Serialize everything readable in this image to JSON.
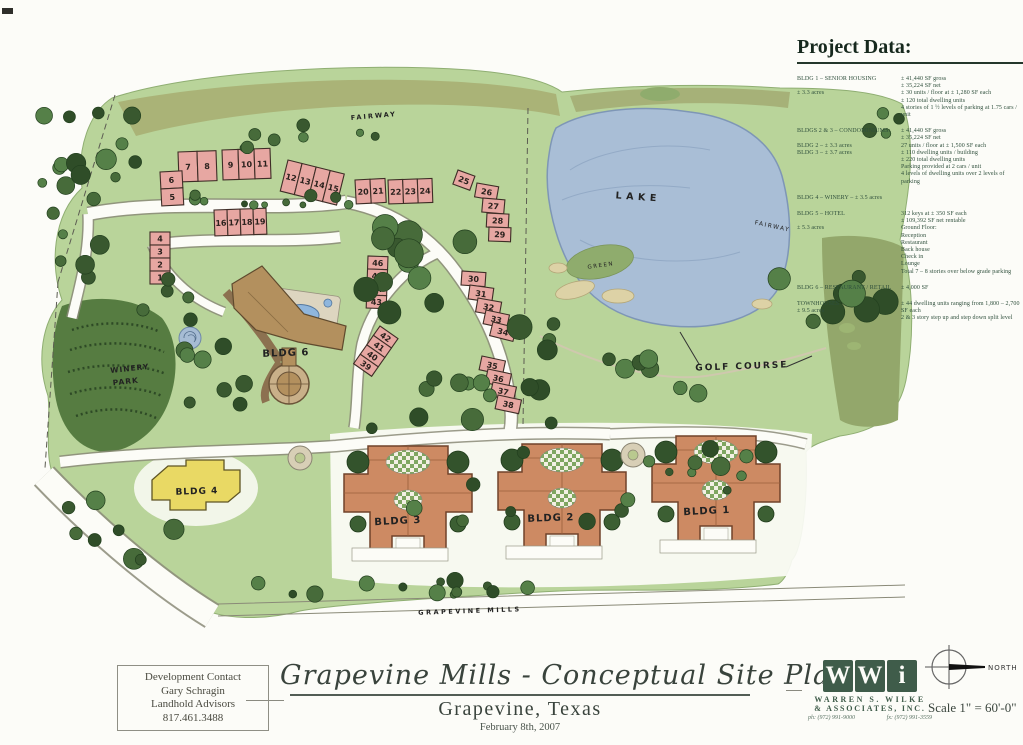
{
  "project_data": {
    "heading": "Project Data:",
    "sections": [
      {
        "left": [
          "BLDG 1 – SENIOR HOUSING",
          "",
          "± 3.3 acres"
        ],
        "right": [
          "± 41,440 SF gross",
          "± 35,224 SF net",
          "± 30 units / floor at ± 1,280 SF each",
          "± 120 total dwelling units",
          "4 stories of 1 ½ levels of parking at 1.75 cars / unit"
        ]
      },
      {
        "left": [
          "BLDGS 2 & 3 – CONDOMINIUMS:",
          "",
          "BLDG 2 – ± 3.3 acres",
          "BLDG 3 – ± 3.7  acres"
        ],
        "right": [
          "± 41,440 SF gross",
          "± 35,224 SF net",
          "27 units / floor at ± 1,500 SF each",
          "± 110 dwelling units / building",
          "± 220 total dwelling units",
          "Parking provided at 2 cars / unit",
          "4 levels of dwelling units over 2 levels of parking"
        ]
      },
      {
        "left": [
          "BLDG 4 – WINERY – ± 3.5 acres"
        ],
        "right": [
          ""
        ]
      },
      {
        "left": [
          "BLDG 5 – HOTEL",
          "",
          "± 5.3 acres"
        ],
        "right": [
          "312 keys at ± 350 SF each",
          "± 109,392 SF net rentable",
          "Ground Floor:",
          "Reception",
          "Restaurant",
          "Back house",
          "Check in",
          "Lounge",
          "Total 7 – 8 stories over below grade parking"
        ]
      },
      {
        "left": [
          "BLDG 6 – RESTAURANT / RETAIL"
        ],
        "right": [
          "± 4,000 SF"
        ]
      },
      {
        "left": [
          "TOWNHOUSES",
          "± 9.5 acres"
        ],
        "right": [
          "± 44 dwelling units ranging from 1,800 – 2,700 SF each",
          "2 & 3 story step up and step down split level"
        ]
      }
    ]
  },
  "map": {
    "labels": {
      "lake": "LAKE",
      "golf_course": "GOLF COURSE",
      "fairway": "FAIRWAY",
      "green": "GREEN",
      "winery_line1": "WINERY",
      "winery_line2": "PARK",
      "street": "GRAPEVINE  MILLS",
      "bldg1": "BLDG 1",
      "bldg2": "BLDG 2",
      "bldg3": "BLDG 3",
      "bldg4": "BLDG 4",
      "bldg6": "BLDG 6"
    },
    "townhouse_clusters": [
      {
        "x": 178,
        "y": 152,
        "w": 38,
        "h": 30,
        "rot": -2,
        "dir": "h",
        "nums": [
          "7",
          "8"
        ]
      },
      {
        "x": 222,
        "y": 150,
        "w": 48,
        "h": 30,
        "rot": -2,
        "dir": "h",
        "nums": [
          "9",
          "10",
          "11"
        ]
      },
      {
        "x": 160,
        "y": 172,
        "w": 22,
        "h": 34,
        "rot": -3,
        "dir": "v",
        "nums": [
          "6",
          "5"
        ]
      },
      {
        "x": 288,
        "y": 160,
        "w": 58,
        "h": 32,
        "rot": 14,
        "dir": "h",
        "nums": [
          "12",
          "13",
          "14",
          "15"
        ]
      },
      {
        "x": 214,
        "y": 210,
        "w": 52,
        "h": 26,
        "rot": -2,
        "dir": "h",
        "nums": [
          "16",
          "17",
          "18",
          "19"
        ]
      },
      {
        "x": 150,
        "y": 232,
        "w": 20,
        "h": 52,
        "rot": 0,
        "dir": "v",
        "nums": [
          "4",
          "3",
          "2",
          "1"
        ]
      },
      {
        "x": 355,
        "y": 180,
        "w": 30,
        "h": 24,
        "rot": -3,
        "dir": "h",
        "nums": [
          "20",
          "21"
        ]
      },
      {
        "x": 388,
        "y": 180,
        "w": 44,
        "h": 24,
        "rot": -2,
        "dir": "h",
        "nums": [
          "22",
          "23",
          "24"
        ]
      },
      {
        "x": 458,
        "y": 170,
        "w": 18,
        "h": 15,
        "rot": 20,
        "dir": "h",
        "nums": [
          "25"
        ]
      },
      {
        "x": 477,
        "y": 183,
        "w": 22,
        "h": 14,
        "rot": 10,
        "dir": "h",
        "nums": [
          "26"
        ]
      },
      {
        "x": 483,
        "y": 198,
        "w": 22,
        "h": 14,
        "rot": 5,
        "dir": "h",
        "nums": [
          "27"
        ]
      },
      {
        "x": 487,
        "y": 213,
        "w": 22,
        "h": 14,
        "rot": 3,
        "dir": "h",
        "nums": [
          "28"
        ]
      },
      {
        "x": 489,
        "y": 227,
        "w": 22,
        "h": 14,
        "rot": 2,
        "dir": "h",
        "nums": [
          "29"
        ]
      },
      {
        "x": 368,
        "y": 256,
        "w": 20,
        "h": 52,
        "rot": 2,
        "dir": "v",
        "nums": [
          "46",
          "45",
          "44",
          "43"
        ]
      },
      {
        "x": 462,
        "y": 271,
        "w": 24,
        "h": 14,
        "rot": 4,
        "dir": "h",
        "nums": [
          "30"
        ]
      },
      {
        "x": 470,
        "y": 285,
        "w": 24,
        "h": 14,
        "rot": 8,
        "dir": "h",
        "nums": [
          "31"
        ]
      },
      {
        "x": 478,
        "y": 298,
        "w": 24,
        "h": 14,
        "rot": 10,
        "dir": "h",
        "nums": [
          "32"
        ]
      },
      {
        "x": 486,
        "y": 310,
        "w": 24,
        "h": 14,
        "rot": 12,
        "dir": "h",
        "nums": [
          "33"
        ]
      },
      {
        "x": 493,
        "y": 322,
        "w": 24,
        "h": 14,
        "rot": 14,
        "dir": "h",
        "nums": [
          "34"
        ]
      },
      {
        "x": 380,
        "y": 326,
        "w": 22,
        "h": 46,
        "rot": 35,
        "dir": "v",
        "nums": [
          "42",
          "41",
          "40",
          "39"
        ]
      },
      {
        "x": 482,
        "y": 356,
        "w": 24,
        "h": 14,
        "rot": 12,
        "dir": "h",
        "nums": [
          "35"
        ]
      },
      {
        "x": 488,
        "y": 369,
        "w": 24,
        "h": 14,
        "rot": 12,
        "dir": "h",
        "nums": [
          "36"
        ]
      },
      {
        "x": 493,
        "y": 382,
        "w": 24,
        "h": 14,
        "rot": 12,
        "dir": "h",
        "nums": [
          "37"
        ]
      },
      {
        "x": 498,
        "y": 395,
        "w": 24,
        "h": 14,
        "rot": 12,
        "dir": "h",
        "nums": [
          "38"
        ]
      }
    ]
  },
  "footer": {
    "contact": {
      "lines": [
        "Development Contact",
        "Gary Schragin",
        "Landhold Advisors",
        "817.461.3488"
      ]
    },
    "title_block": {
      "title": "Grapevine Mills - Conceptual Site Plan",
      "city": "Grapevine, Texas",
      "date": "February 8th, 2007"
    },
    "firm": {
      "logo_letters": [
        "W",
        "W",
        "i"
      ],
      "name_line1": "WARREN S. WILKE",
      "name_line2": "& ASSOCIATES, INC.",
      "phone": "ph: (972) 991-9000",
      "fax": "fx: (972) 991-3559"
    },
    "compass_label": "NORTH",
    "scale_text": "Scale 1\" = 60'-0\""
  },
  "colors": {
    "grass": "#b9d49a",
    "fairway_olive": "#a9b175",
    "lake_blue": "#a9bed6",
    "tree_dark": "#3a5c30",
    "townhouse_pink": "#e7a7a2",
    "condo_salmon": "#cd8a63",
    "bldg6_tan": "#b3905e",
    "bldg4_yellow": "#e9d964",
    "firm_green": "#3f5c4a"
  }
}
